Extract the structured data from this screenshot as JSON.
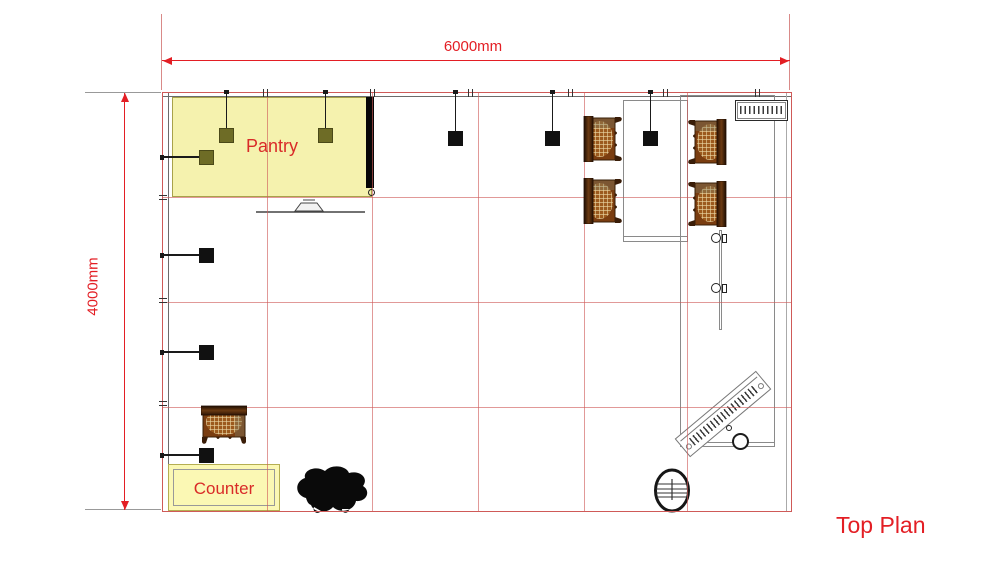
{
  "title_label": "Top Plan",
  "dimensions": {
    "horizontal": "6000mm",
    "vertical": "4000mm"
  },
  "labels": {
    "pantry": "Pantry",
    "counter": "Counter"
  },
  "colors": {
    "dim_red": "#e31e24",
    "grid_red": "#cf5a58",
    "label_red": "#d92b28",
    "pantry_fill": "#f5f2ae",
    "pantry_border": "#a8a24a",
    "counter_fill": "#fbf8b4",
    "counter_border": "#b5ae52",
    "olive_fixture": "#6e6c26",
    "black_fixture": "#111111",
    "wall_grey": "#6b6b6b",
    "furn_grey": "#8a8a8a",
    "chair_frame": "#3a1d08",
    "chair_seat": "#7a3d10",
    "chair_weave": "#ecd9a6"
  },
  "plan": {
    "x": 162,
    "y": 92,
    "w": 630,
    "h": 420
  },
  "grid": {
    "v_lines": [
      267,
      372,
      478,
      584,
      687
    ],
    "h_lines": [
      197,
      302,
      407
    ]
  },
  "wall_ticks": {
    "top_x": [
      265,
      372,
      470,
      570,
      665,
      757
    ],
    "left_y": [
      197,
      300,
      403
    ]
  },
  "lights": {
    "ceiling": [
      {
        "cx": 226,
        "sq_y": 128,
        "variant": "olive"
      },
      {
        "cx": 325,
        "sq_y": 128,
        "variant": "olive"
      },
      {
        "cx": 455,
        "sq_y": 131,
        "variant": "black"
      },
      {
        "cx": 552,
        "sq_y": 131,
        "variant": "black"
      },
      {
        "cx": 650,
        "sq_y": 131,
        "variant": "black"
      }
    ],
    "wall": [
      {
        "cy": 157,
        "variant": "olive"
      },
      {
        "cy": 255,
        "variant": "black"
      },
      {
        "cy": 352,
        "variant": "black"
      },
      {
        "cy": 455,
        "variant": "black"
      }
    ]
  },
  "chairs": [
    {
      "x": 583,
      "y": 116,
      "facing": "right"
    },
    {
      "x": 583,
      "y": 178,
      "facing": "right"
    },
    {
      "x": 687,
      "y": 119,
      "facing": "left"
    },
    {
      "x": 687,
      "y": 181,
      "facing": "left"
    },
    {
      "x": 204,
      "y": 402,
      "facing": "down"
    }
  ],
  "hooks": [
    {
      "x": 711,
      "y": 233
    },
    {
      "x": 711,
      "y": 283
    }
  ]
}
